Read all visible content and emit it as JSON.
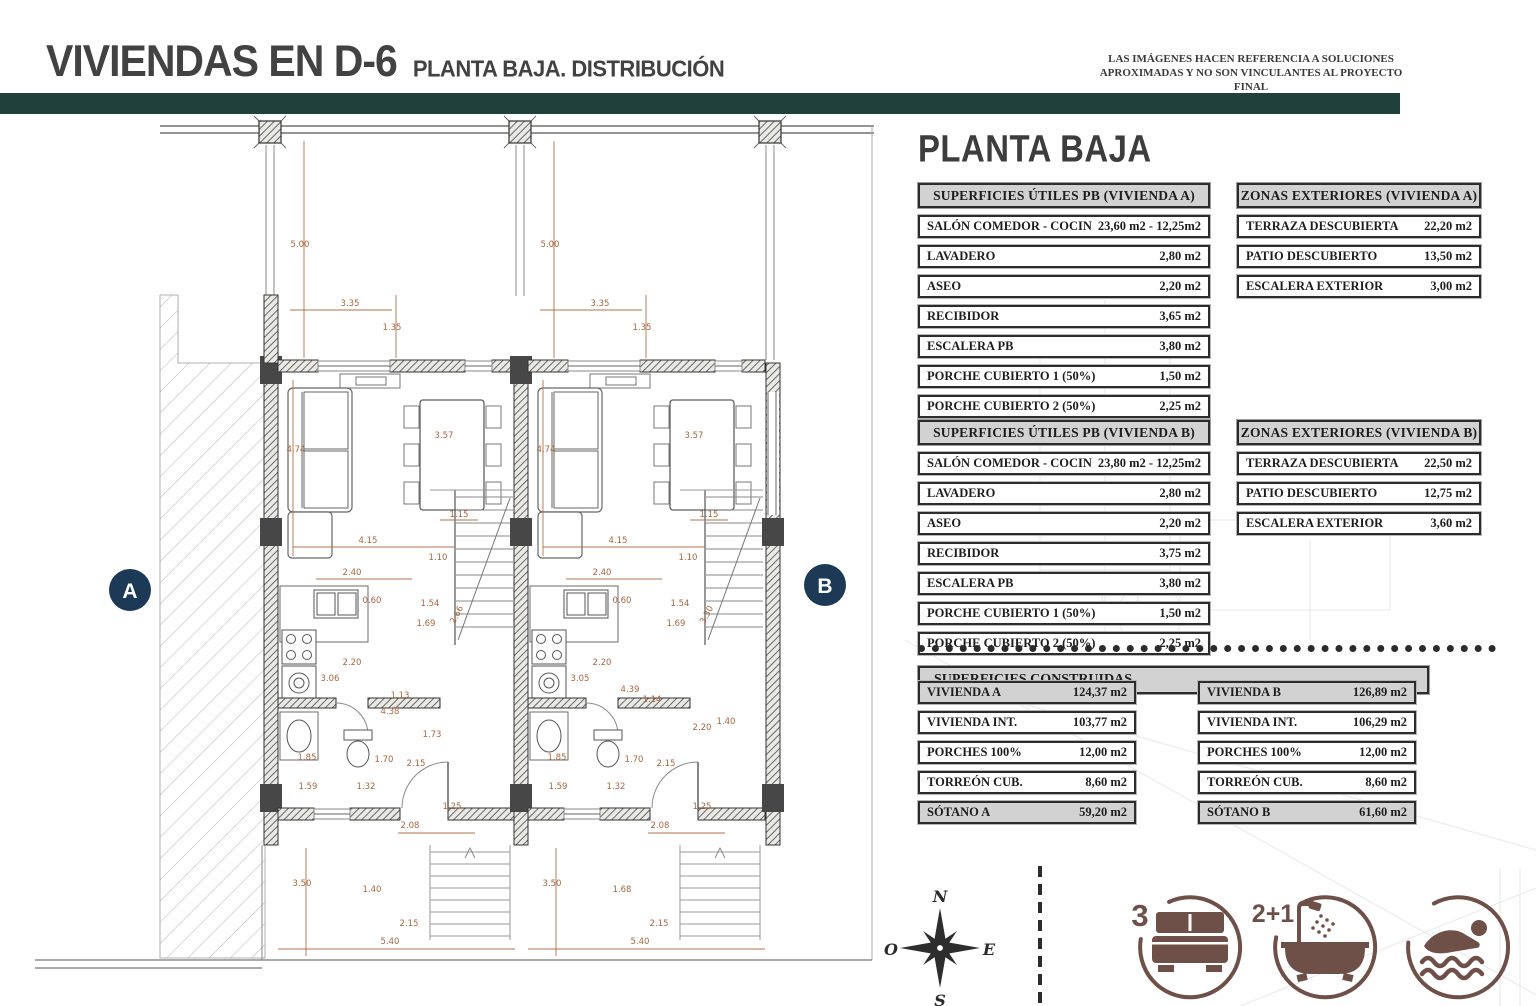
{
  "header": {
    "title_main": "VIVIENDAS EN D-6",
    "title_sub": "PLANTA BAJA. DISTRIBUCIÓN",
    "disclaimer_line1": "LAS IMÁGENES HACEN REFERENCIA A SOLUCIONES",
    "disclaimer_line2": "APROXIMADAS Y NO SON VINCULANTES AL PROYECTO FINAL"
  },
  "colors": {
    "accent_teal": "#20413b",
    "dimension_sienna": "#a8653f",
    "marker_navy": "#1c3a55",
    "icon_brown": "#6f5049",
    "table_header_fill": "#d2d2d2"
  },
  "panel": {
    "heading": "PLANTA BAJA"
  },
  "tables": {
    "utiles_a": {
      "title": "SUPERFICIES ÚTILES PB (VIVIENDA A)",
      "rows": [
        {
          "label": "SALÓN COMEDOR  - COCINA",
          "value": "23,60 m2 - 12,25m2"
        },
        {
          "label": "LAVADERO",
          "value": "2,80 m2"
        },
        {
          "label": "ASEO",
          "value": "2,20 m2"
        },
        {
          "label": "RECIBIDOR",
          "value": "3,65 m2"
        },
        {
          "label": "ESCALERA PB",
          "value": "3,80 m2"
        },
        {
          "label": "PORCHE CUBIERTO 1 (50%)",
          "value": "1,50 m2"
        },
        {
          "label": "PORCHE CUBIERTO 2 (50%)",
          "value": "2,25 m2"
        }
      ]
    },
    "zonas_a": {
      "title": "ZONAS EXTERIORES (VIVIENDA A)",
      "rows": [
        {
          "label": "TERRAZA DESCUBIERTA",
          "value": "22,20 m2"
        },
        {
          "label": "PATIO DESCUBIERTO",
          "value": "13,50 m2"
        },
        {
          "label": "ESCALERA EXTERIOR",
          "value": "3,00 m2"
        }
      ]
    },
    "utiles_b": {
      "title": "SUPERFICIES ÚTILES PB (VIVIENDA B)",
      "rows": [
        {
          "label": "SALÓN COMEDOR  - COCINA",
          "value": "23,80 m2 - 12,25m2"
        },
        {
          "label": "LAVADERO",
          "value": "2,80 m2"
        },
        {
          "label": "ASEO",
          "value": "2,20 m2"
        },
        {
          "label": "RECIBIDOR",
          "value": "3,75 m2"
        },
        {
          "label": "ESCALERA PB",
          "value": "3,80 m2"
        },
        {
          "label": "PORCHE CUBIERTO 1 (50%)",
          "value": "1,50 m2"
        },
        {
          "label": "PORCHE CUBIERTO 2 (50%)",
          "value": "2,25 m2"
        }
      ]
    },
    "zonas_b": {
      "title": "ZONAS EXTERIORES (VIVIENDA B)",
      "rows": [
        {
          "label": "TERRAZA DESCUBIERTA",
          "value": "22,50 m2"
        },
        {
          "label": "PATIO DESCUBIERTO",
          "value": "12,75 m2"
        },
        {
          "label": "ESCALERA EXTERIOR",
          "value": "3,60 m2"
        }
      ]
    },
    "construidas": {
      "title": "SUPERFICIES CONSTRUIDAS",
      "left": [
        {
          "label": "VIVIENDA A",
          "value": "124,37 m2",
          "shaded": true
        },
        {
          "label": "VIVIENDA INT.",
          "value": "103,77 m2"
        },
        {
          "label": "PORCHES 100%",
          "value": "12,00 m2"
        },
        {
          "label": "TORREÓN CUB.",
          "value": "8,60 m2"
        },
        {
          "label": "SÓTANO A",
          "value": "59,20 m2",
          "shaded": true
        }
      ],
      "right": [
        {
          "label": "VIVIENDA B",
          "value": "126,89 m2",
          "shaded": true
        },
        {
          "label": "VIVIENDA INT.",
          "value": "106,29 m2"
        },
        {
          "label": "PORCHES 100%",
          "value": "12,00 m2"
        },
        {
          "label": "TORREÓN CUB.",
          "value": "8,60 m2"
        },
        {
          "label": "SÓTANO B",
          "value": "61,60 m2",
          "shaded": true
        }
      ]
    }
  },
  "plan": {
    "marker_a": "A",
    "marker_b": "B",
    "dimensions": [
      {
        "t": "5.00",
        "x": 300,
        "y": 247
      },
      {
        "t": "3.35",
        "x": 350,
        "y": 306
      },
      {
        "t": "1.35",
        "x": 392,
        "y": 330
      },
      {
        "t": "4.74",
        "x": 296,
        "y": 452
      },
      {
        "t": "3.57",
        "x": 444,
        "y": 438
      },
      {
        "t": "1.15",
        "x": 459,
        "y": 517
      },
      {
        "t": "4.15",
        "x": 368,
        "y": 543
      },
      {
        "t": "1.10",
        "x": 438,
        "y": 560
      },
      {
        "t": "2.40",
        "x": 352,
        "y": 575
      },
      {
        "t": "0.60",
        "x": 372,
        "y": 603
      },
      {
        "t": "1.54",
        "x": 430,
        "y": 606
      },
      {
        "t": "1.69",
        "x": 426,
        "y": 626
      },
      {
        "t": "2.66",
        "x": 459,
        "y": 616,
        "r": -62
      },
      {
        "t": "2.20",
        "x": 352,
        "y": 665
      },
      {
        "t": "3.06",
        "x": 330,
        "y": 681
      },
      {
        "t": "1.13",
        "x": 400,
        "y": 698
      },
      {
        "t": "4.38",
        "x": 390,
        "y": 714
      },
      {
        "t": "1.73",
        "x": 432,
        "y": 737
      },
      {
        "t": "2.15",
        "x": 416,
        "y": 766
      },
      {
        "t": "1.85",
        "x": 307,
        "y": 760
      },
      {
        "t": "1.70",
        "x": 384,
        "y": 762
      },
      {
        "t": "1.59",
        "x": 308,
        "y": 789
      },
      {
        "t": "1.32",
        "x": 366,
        "y": 789
      },
      {
        "t": "1.25",
        "x": 452,
        "y": 809
      },
      {
        "t": "2.08",
        "x": 410,
        "y": 828
      },
      {
        "t": "3.50",
        "x": 302,
        "y": 886
      },
      {
        "t": "1.40",
        "x": 372,
        "y": 892
      },
      {
        "t": "2.15",
        "x": 409,
        "y": 926
      },
      {
        "t": "5.40",
        "x": 390,
        "y": 944
      },
      {
        "t": "5.00",
        "x": 550,
        "y": 247
      },
      {
        "t": "3.35",
        "x": 600,
        "y": 306
      },
      {
        "t": "1.35",
        "x": 642,
        "y": 330
      },
      {
        "t": "4.74",
        "x": 546,
        "y": 452
      },
      {
        "t": "3.57",
        "x": 694,
        "y": 438
      },
      {
        "t": "1.15",
        "x": 709,
        "y": 517
      },
      {
        "t": "4.15",
        "x": 618,
        "y": 543
      },
      {
        "t": "1.10",
        "x": 688,
        "y": 560
      },
      {
        "t": "2.40",
        "x": 602,
        "y": 575
      },
      {
        "t": "0.60",
        "x": 622,
        "y": 603
      },
      {
        "t": "1.54",
        "x": 680,
        "y": 606
      },
      {
        "t": "1.69",
        "x": 676,
        "y": 626
      },
      {
        "t": "3.30",
        "x": 709,
        "y": 616,
        "r": -62
      },
      {
        "t": "2.20",
        "x": 602,
        "y": 665
      },
      {
        "t": "3.05",
        "x": 580,
        "y": 681
      },
      {
        "t": "4.39",
        "x": 630,
        "y": 692
      },
      {
        "t": "1.14",
        "x": 652,
        "y": 702
      },
      {
        "t": "2.20",
        "x": 702,
        "y": 730
      },
      {
        "t": "1.40",
        "x": 726,
        "y": 724
      },
      {
        "t": "2.15",
        "x": 666,
        "y": 766
      },
      {
        "t": "1.85",
        "x": 557,
        "y": 760
      },
      {
        "t": "1.70",
        "x": 634,
        "y": 762
      },
      {
        "t": "1.59",
        "x": 558,
        "y": 789
      },
      {
        "t": "1.32",
        "x": 616,
        "y": 789
      },
      {
        "t": "1.25",
        "x": 702,
        "y": 809
      },
      {
        "t": "2.08",
        "x": 660,
        "y": 828
      },
      {
        "t": "3.50",
        "x": 552,
        "y": 886
      },
      {
        "t": "1.68",
        "x": 622,
        "y": 892
      },
      {
        "t": "2.15",
        "x": 659,
        "y": 926
      },
      {
        "t": "5.40",
        "x": 640,
        "y": 944
      }
    ]
  },
  "compass": {
    "north": "N",
    "east": "E",
    "south": "S",
    "west": "O"
  },
  "features": {
    "bedrooms": "3",
    "bathrooms": "2+1"
  }
}
